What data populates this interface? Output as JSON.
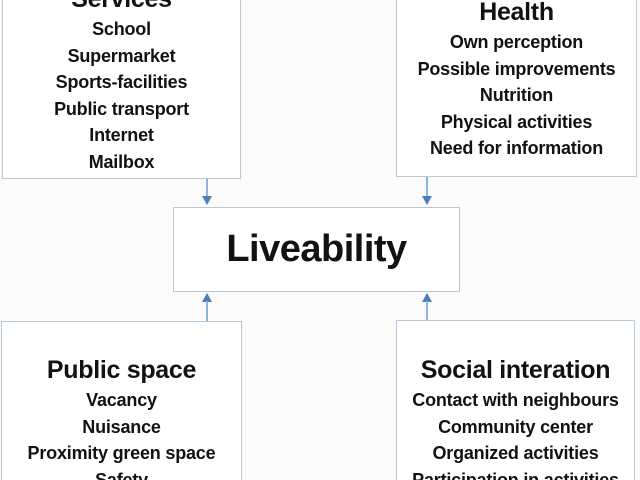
{
  "diagram": {
    "center_label": "Liveability",
    "services": {
      "title": "Services",
      "items": [
        "School",
        "Supermarket",
        "Sports-facilities",
        "Public transport",
        "Internet",
        "Mailbox"
      ]
    },
    "health": {
      "title": "Health",
      "items": [
        "Own perception",
        "Possible improvements",
        "Nutrition",
        "Physical activities",
        "Need for information"
      ]
    },
    "public_space": {
      "title": "Public space",
      "items": [
        "Vacancy",
        "Nuisance",
        "Proximity green space",
        "Safety"
      ]
    },
    "social_interaction": {
      "title": "Social interation",
      "items": [
        "Contact with neighbours",
        "Community center",
        "Organized activities",
        "Participation in activities"
      ]
    }
  },
  "colors": {
    "background": "#fbfbfb",
    "box_fill": "#ffffff",
    "box_border": "#b6c8da",
    "arrow_line": "#8fb3da",
    "arrow_head": "#4a7ebb",
    "text": "#121212"
  }
}
